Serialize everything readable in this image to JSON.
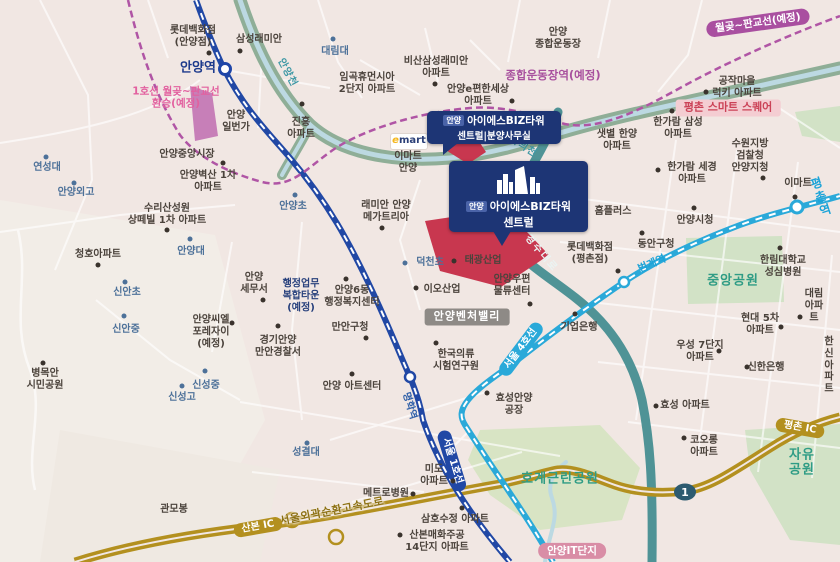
{
  "route_shield": "1",
  "colors": {
    "background": "#f1e7e3",
    "line1_blue": "#2148a5",
    "line4_cyan": "#2aa9d9",
    "wolgot_pangyo_purple": "#b055a5",
    "expressway_gold": "#b3901f",
    "gyeongsu_road_teal": "#4f9396",
    "river_green": "#8fae97",
    "site_red": "#c8374f",
    "callout_navy": "#1d3575"
  },
  "callouts": {
    "main": {
      "prefix": "안양",
      "name": "아이에스BIZ타워",
      "sub": "센트럴"
    },
    "office": {
      "prefix": "안양",
      "name": "아이에스BIZ타워",
      "sub": "센트럴|분양사무실"
    }
  },
  "emart_logo": {
    "e": "e",
    "mart": "mart"
  },
  "labels": [
    {
      "text": "롯데백화점\n(안양점)",
      "x": 193,
      "y": 37,
      "cls": "place",
      "dot": [
        209,
        53
      ]
    },
    {
      "text": "삼성래미안",
      "x": 259,
      "y": 40,
      "cls": "place",
      "dot": [
        240,
        51
      ]
    },
    {
      "text": "안양역",
      "x": 198,
      "y": 68,
      "cls": "station-l1-big"
    },
    {
      "text": "1호선 월곶~판교선\n환승(예정)",
      "x": 176,
      "y": 98,
      "cls": "pink"
    },
    {
      "text": "안양\n일번가",
      "x": 236,
      "y": 122,
      "cls": "place"
    },
    {
      "text": "진흥\n아파트",
      "x": 301,
      "y": 129,
      "cls": "place",
      "dot": [
        302,
        104
      ]
    },
    {
      "text": "대림대",
      "x": 335,
      "y": 52,
      "cls": "school",
      "dot": [
        333,
        39
      ]
    },
    {
      "text": "임곡휴먼시아\n2단지 아파트",
      "x": 367,
      "y": 84,
      "cls": "place"
    },
    {
      "text": "비산삼성래미안\n아파트",
      "x": 436,
      "y": 68,
      "cls": "place",
      "dot": [
        435,
        84
      ]
    },
    {
      "text": "안양e편한세상\n아파트",
      "x": 478,
      "y": 96,
      "cls": "place",
      "dot": [
        512,
        101
      ]
    },
    {
      "text": "안양\n종합운동장",
      "x": 558,
      "y": 39,
      "cls": "place"
    },
    {
      "text": "안양천",
      "x": 287,
      "y": 73,
      "cls": "river",
      "rot": 62
    },
    {
      "text": "학의천",
      "x": 523,
      "y": 147,
      "cls": "river",
      "rot": 33
    },
    {
      "text": "종합운동장역(예정)",
      "x": 553,
      "y": 76,
      "cls": "purple"
    },
    {
      "text": "월곶~판교선(예정)",
      "x": 758,
      "y": 23,
      "cls": "pill-purple",
      "rot": -8
    },
    {
      "text": "공작마을\n럭키 아파트",
      "x": 737,
      "y": 88,
      "cls": "place",
      "dot": [
        706,
        92
      ]
    },
    {
      "text": "평촌 스마트 스퀘어",
      "x": 728,
      "y": 108,
      "cls": "badge-pink"
    },
    {
      "text": "샛별 한양\n아파트",
      "x": 617,
      "y": 141,
      "cls": "place"
    },
    {
      "text": "한가람 삼성\n아파트",
      "x": 678,
      "y": 129,
      "cls": "place",
      "dot": [
        672,
        111
      ]
    },
    {
      "text": "수원지방\n검찰청\n안양지청",
      "x": 750,
      "y": 156,
      "cls": "place",
      "dot": [
        763,
        178
      ]
    },
    {
      "text": "한가람 세경\n아파트",
      "x": 692,
      "y": 174,
      "cls": "place",
      "dot": [
        658,
        170
      ]
    },
    {
      "text": "이마트",
      "x": 798,
      "y": 184,
      "cls": "place",
      "dot": [
        795,
        197
      ]
    },
    {
      "text": "평촌역",
      "x": 821,
      "y": 197,
      "cls": "station-l4-big",
      "rot": -18
    },
    {
      "text": "안양중앙시장",
      "x": 187,
      "y": 155,
      "cls": "place",
      "dot": [
        223,
        163
      ]
    },
    {
      "text": "안양벽산 1차\n아파트",
      "x": 208,
      "y": 182,
      "cls": "place"
    },
    {
      "text": "연성대",
      "x": 47,
      "y": 168,
      "cls": "school",
      "dot": [
        46,
        157
      ]
    },
    {
      "text": "안양외고",
      "x": 76,
      "y": 193,
      "cls": "school",
      "dot": [
        74,
        183
      ]
    },
    {
      "text": "수리산성원\n상떼빌 1차 아파트",
      "x": 167,
      "y": 215,
      "cls": "place",
      "dot": [
        167,
        230
      ]
    },
    {
      "text": "안양대",
      "x": 191,
      "y": 252,
      "cls": "school",
      "dot": [
        190,
        239
      ]
    },
    {
      "text": "청호아파트",
      "x": 98,
      "y": 255,
      "cls": "place",
      "dot": [
        98,
        265
      ]
    },
    {
      "text": "안양초",
      "x": 293,
      "y": 207,
      "cls": "school",
      "dot": [
        295,
        195
      ]
    },
    {
      "text": "래미안 안양\n메가트리아",
      "x": 386,
      "y": 212,
      "cls": "place",
      "dot": [
        382,
        228
      ]
    },
    {
      "text": "이마트\n안양",
      "x": 408,
      "y": 163,
      "cls": "place"
    },
    {
      "text": "관악 부영\n아파트",
      "x": 563,
      "y": 180,
      "cls": "place",
      "dot": [
        541,
        194
      ]
    },
    {
      "text": "홈플러스",
      "x": 613,
      "y": 212,
      "cls": "place",
      "dot": [
        577,
        227
      ]
    },
    {
      "text": "안양시청",
      "x": 695,
      "y": 221,
      "cls": "place",
      "dot": [
        694,
        208
      ]
    },
    {
      "text": "동안구청",
      "x": 656,
      "y": 245,
      "cls": "place",
      "dot": [
        642,
        233
      ]
    },
    {
      "text": "롯데백화점\n(평촌점)",
      "x": 590,
      "y": 254,
      "cls": "place",
      "dot": [
        618,
        271
      ]
    },
    {
      "text": "한림대학교\n성심병원",
      "x": 783,
      "y": 267,
      "cls": "place",
      "dot": [
        780,
        248
      ]
    },
    {
      "text": "중앙공원",
      "x": 733,
      "y": 281,
      "cls": "park"
    },
    {
      "text": "대림아파트",
      "x": 814,
      "y": 306,
      "cls": "place",
      "dot": [
        800,
        317
      ]
    },
    {
      "text": "현대 5차\n아파트",
      "x": 760,
      "y": 325,
      "cls": "place",
      "dot": [
        781,
        327
      ]
    },
    {
      "text": "우성 7단지\n아파트",
      "x": 700,
      "y": 352,
      "cls": "place",
      "dot": [
        719,
        351
      ]
    },
    {
      "text": "신한은행",
      "x": 766,
      "y": 368,
      "cls": "place",
      "dot": [
        747,
        367
      ]
    },
    {
      "text": "한신\n아파트",
      "x": 829,
      "y": 366,
      "cls": "place"
    },
    {
      "text": "기업은행",
      "x": 579,
      "y": 328,
      "cls": "place",
      "dot": [
        575,
        314
      ]
    },
    {
      "text": "효성 아파트",
      "x": 685,
      "y": 406,
      "cls": "place",
      "dot": [
        656,
        406
      ]
    },
    {
      "text": "코오롱\n아파트",
      "x": 704,
      "y": 447,
      "cls": "place",
      "dot": [
        684,
        438
      ]
    },
    {
      "text": "자유공원",
      "x": 802,
      "y": 463,
      "cls": "park"
    },
    {
      "text": "호계근린공원",
      "x": 560,
      "y": 479,
      "cls": "park"
    },
    {
      "text": "효성안양\n공장",
      "x": 514,
      "y": 405,
      "cls": "place",
      "dot": [
        487,
        393
      ]
    },
    {
      "text": "한국의류\n시험연구원",
      "x": 456,
      "y": 361,
      "cls": "place",
      "dot": [
        436,
        343
      ]
    },
    {
      "text": "이오산업",
      "x": 442,
      "y": 290,
      "cls": "place",
      "dot": [
        416,
        288
      ]
    },
    {
      "text": "안양우편\n물류센터",
      "x": 512,
      "y": 286,
      "cls": "place",
      "dot": [
        530,
        304
      ]
    },
    {
      "text": "안양벤처밸리",
      "x": 467,
      "y": 317,
      "cls": "badge-gray"
    },
    {
      "text": "덕천초",
      "x": 430,
      "y": 263,
      "cls": "school",
      "dot": [
        405,
        263
      ]
    },
    {
      "text": "태광산업",
      "x": 483,
      "y": 261,
      "cls": "place",
      "dot": [
        454,
        261
      ]
    },
    {
      "text": "안양\n세무서",
      "x": 254,
      "y": 284,
      "cls": "place",
      "dot": [
        263,
        300
      ]
    },
    {
      "text": "행정업무\n복합타운\n(예정)",
      "x": 301,
      "y": 296,
      "cls": "navy"
    },
    {
      "text": "안양6동\n행정복지센터",
      "x": 352,
      "y": 297,
      "cls": "place",
      "dot": [
        346,
        279
      ]
    },
    {
      "text": "만안구청",
      "x": 350,
      "y": 328,
      "cls": "place",
      "dot": [
        366,
        338
      ]
    },
    {
      "text": "경기안양\n만안경찰서",
      "x": 278,
      "y": 347,
      "cls": "place",
      "dot": [
        278,
        326
      ]
    },
    {
      "text": "안양씨엘\n포레자이\n(예정)",
      "x": 211,
      "y": 332,
      "cls": "place",
      "dot": [
        232,
        323
      ]
    },
    {
      "text": "신안초",
      "x": 127,
      "y": 293,
      "cls": "school",
      "dot": [
        125,
        282
      ]
    },
    {
      "text": "신안중",
      "x": 126,
      "y": 330,
      "cls": "school",
      "dot": [
        124,
        316
      ]
    },
    {
      "text": "병목안\n시민공원",
      "x": 45,
      "y": 380,
      "cls": "place",
      "dot": [
        43,
        363
      ]
    },
    {
      "text": "신성중",
      "x": 206,
      "y": 386,
      "cls": "school",
      "dot": [
        205,
        371
      ]
    },
    {
      "text": "신성고",
      "x": 182,
      "y": 398,
      "cls": "school",
      "dot": [
        182,
        386
      ]
    },
    {
      "text": "안양 아트센터",
      "x": 352,
      "y": 387,
      "cls": "place",
      "dot": [
        352,
        374
      ]
    },
    {
      "text": "명학역",
      "x": 409,
      "y": 406,
      "cls": "station-l1-rot",
      "rot": 73
    },
    {
      "text": "범계역",
      "x": 652,
      "y": 264,
      "cls": "station-l4",
      "rot": -23
    },
    {
      "text": "서울 1호선",
      "x": 452,
      "y": 461,
      "cls": "pill-line1",
      "rot": 73
    },
    {
      "text": "서울 4호선",
      "x": 521,
      "y": 349,
      "cls": "pill-line4",
      "rot": -53
    },
    {
      "text": "경수대로",
      "x": 541,
      "y": 254,
      "cls": "road-teal-label",
      "rot": 50
    },
    {
      "text": "성결대",
      "x": 306,
      "y": 453,
      "cls": "school",
      "dot": [
        307,
        443
      ]
    },
    {
      "text": "미도\n아파트",
      "x": 434,
      "y": 476,
      "cls": "place",
      "dot": [
        453,
        481
      ]
    },
    {
      "text": "메트로병원",
      "x": 386,
      "y": 494,
      "cls": "place",
      "dot": [
        413,
        494
      ]
    },
    {
      "text": "서울외곽순환고속도로",
      "x": 332,
      "y": 512,
      "cls": "road-gold-label",
      "rot": -11
    },
    {
      "text": "삼호수정 아파트",
      "x": 455,
      "y": 520,
      "cls": "place",
      "dot": [
        462,
        508
      ]
    },
    {
      "text": "산본매화주공\n14단지 아파트",
      "x": 437,
      "y": 542,
      "cls": "place",
      "dot": [
        400,
        535
      ]
    },
    {
      "text": "관모봉",
      "x": 174,
      "y": 510,
      "cls": "place"
    },
    {
      "text": "산본 IC",
      "x": 258,
      "y": 527,
      "cls": "pill-gold",
      "rot": -10
    },
    {
      "text": "평촌 IC",
      "x": 800,
      "y": 428,
      "cls": "pill-gold",
      "rot": 10
    },
    {
      "text": "안양IT단지",
      "x": 572,
      "y": 551,
      "cls": "pill-rose"
    }
  ]
}
